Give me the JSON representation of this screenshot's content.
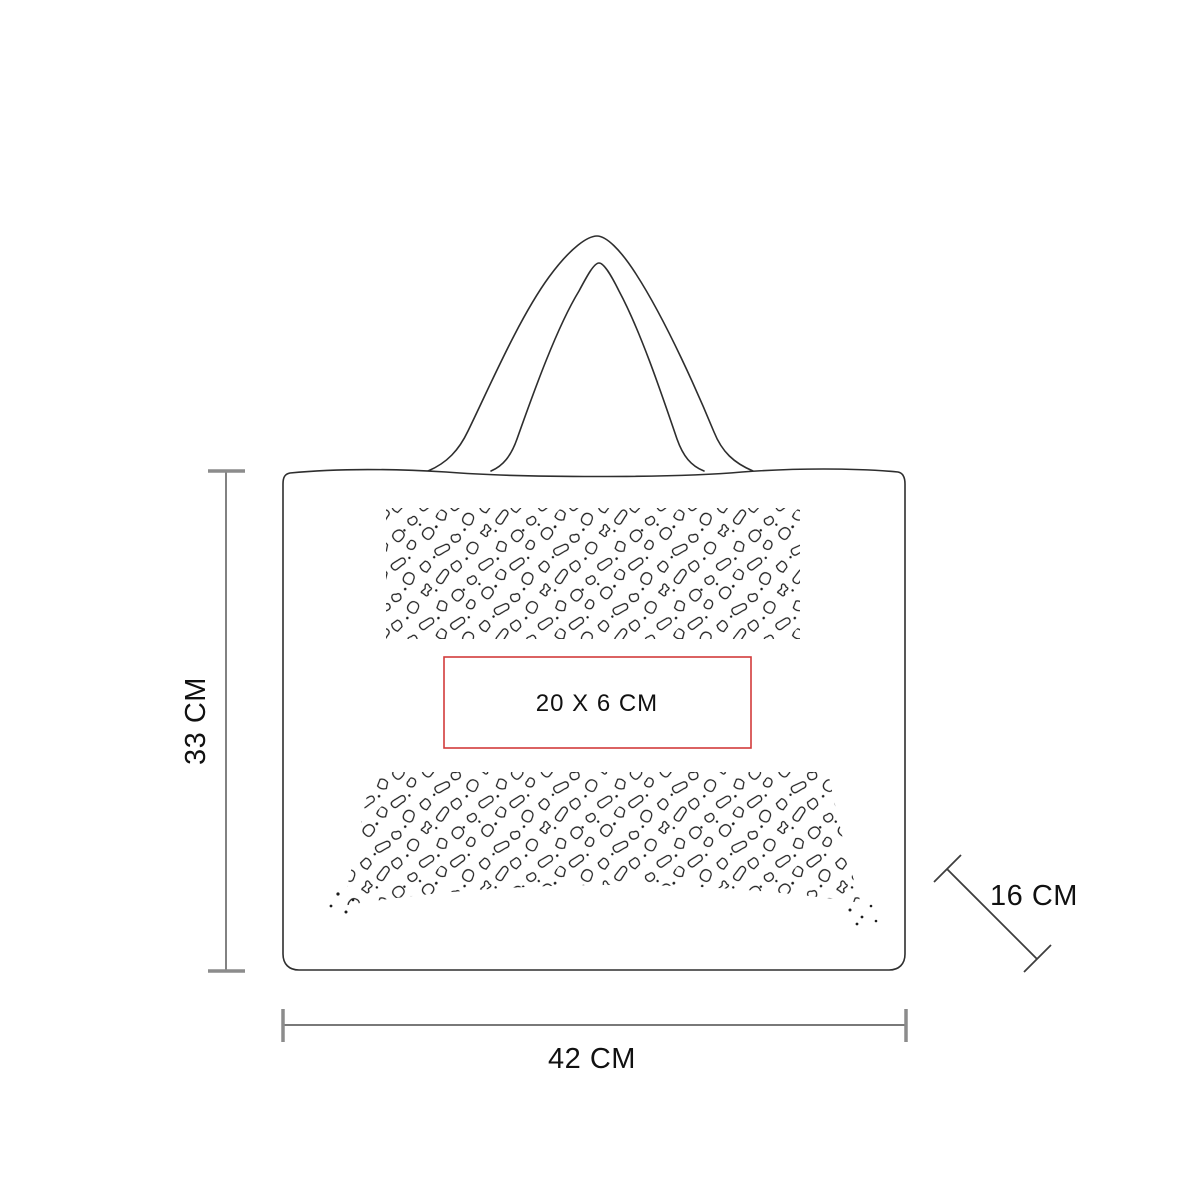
{
  "diagram": {
    "subject": "tote-bag-dimension-diagram",
    "labels": {
      "height": "33 CM",
      "width": "42 CM",
      "depth": "16 CM",
      "imprint": "20 X 6 CM"
    },
    "colors": {
      "imprint_box": "#d23b3b",
      "bag_outline": "#2e2e2e",
      "dimension_line": "#4d4d4d",
      "dimension_tick": "#8c8c8c",
      "pattern_stroke": "#1c1c1c",
      "background": "#ffffff",
      "text": "#111111"
    }
  }
}
